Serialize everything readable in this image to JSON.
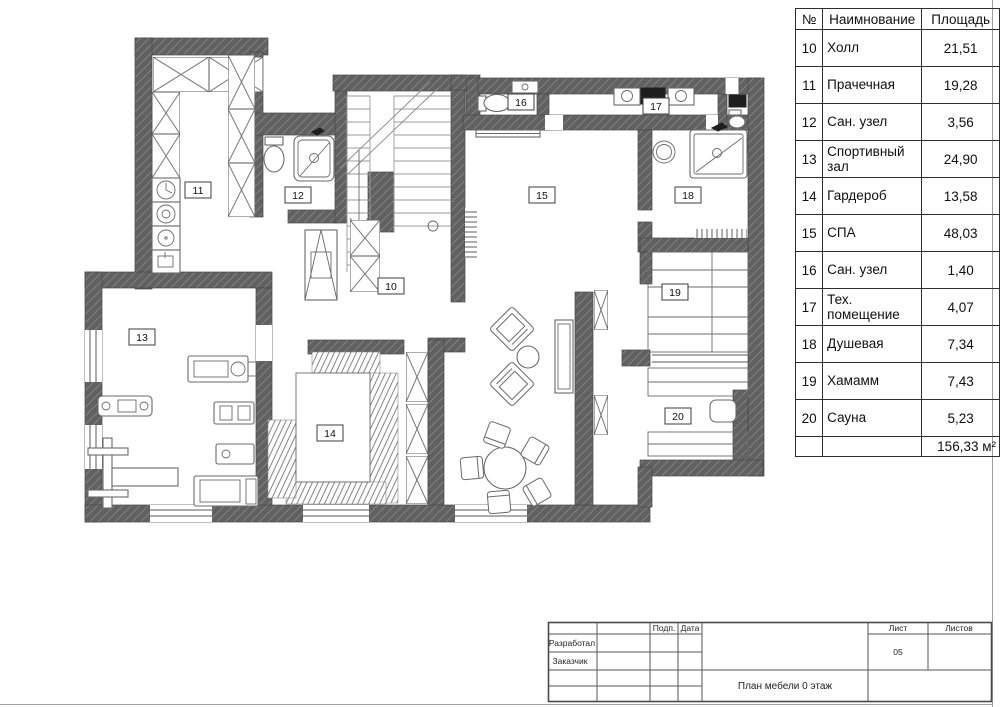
{
  "legend_table": {
    "headers": {
      "no": "№",
      "name": "Наимнование",
      "area": "Площадь"
    },
    "rows": [
      {
        "no": "10",
        "name": "Холл",
        "area": "21,51"
      },
      {
        "no": "11",
        "name": "Прачечная",
        "area": "19,28"
      },
      {
        "no": "12",
        "name": "Сан. узел",
        "area": "3,56"
      },
      {
        "no": "13",
        "name": "Спортивный зал",
        "area": "24,90"
      },
      {
        "no": "14",
        "name": "Гардероб",
        "area": "13,58"
      },
      {
        "no": "15",
        "name": "СПА",
        "area": "48,03"
      },
      {
        "no": "16",
        "name": "Сан. узел",
        "area": "1,40"
      },
      {
        "no": "17",
        "name": "Тех. помещение",
        "area": "4,07"
      },
      {
        "no": "18",
        "name": "Душевая",
        "area": "7,34"
      },
      {
        "no": "19",
        "name": "Хамамм",
        "area": "7,43"
      },
      {
        "no": "20",
        "name": "Сауна",
        "area": "5,23"
      }
    ],
    "total_area": "156,33 м²"
  },
  "plan": {
    "room_labels": [
      {
        "no": "10"
      },
      {
        "no": "11"
      },
      {
        "no": "12"
      },
      {
        "no": "13"
      },
      {
        "no": "14"
      },
      {
        "no": "15"
      },
      {
        "no": "16"
      },
      {
        "no": "17"
      },
      {
        "no": "18"
      },
      {
        "no": "19"
      },
      {
        "no": "20"
      }
    ]
  },
  "title_block": {
    "developed_label": "Разработал",
    "client_label": "Заказчик",
    "signature_label": "Подп.",
    "date_label": "Дата",
    "sheet_label": "Лист",
    "sheets_label": "Листов",
    "sheet_number": "05",
    "drawing_title": "План мебели 0 этаж"
  }
}
